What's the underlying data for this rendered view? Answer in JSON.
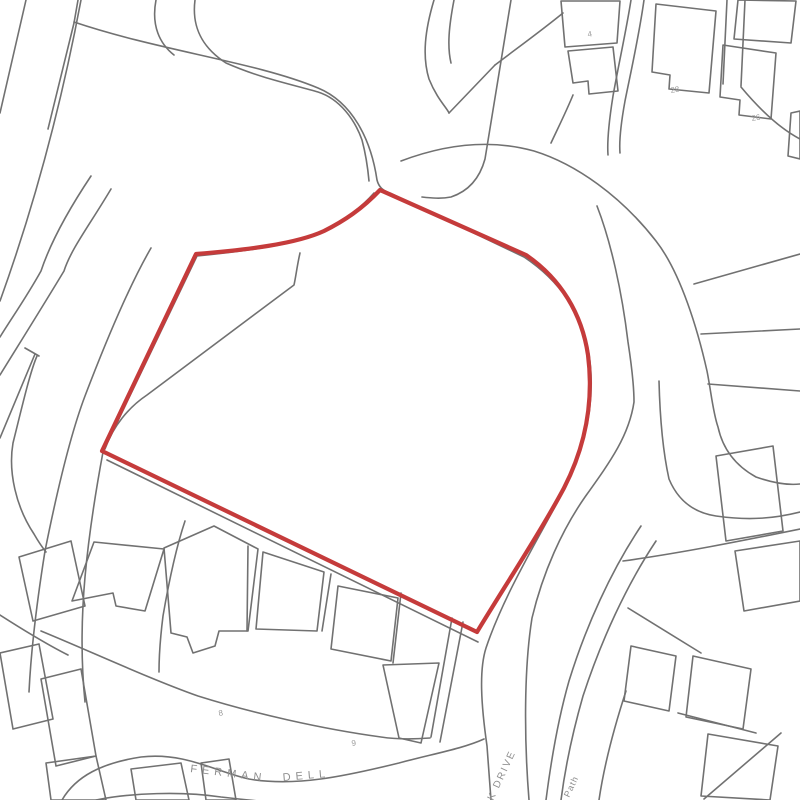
{
  "map": {
    "title": "site-location-plan",
    "background": "#ffffff",
    "line_color": "#717171",
    "line_width": 1.6,
    "red_color": "#c53b3b",
    "red_width": 4.2,
    "label_color": "#8f8f8f",
    "number_color": "#9a9a9a",
    "site_boundary": "M 380,190 C 362,209 344,221 324,231 C 296,244 246,250 196,254 L 102,451 L 477,632 C 503,589 541,531 564,488 C 585,447 594,402 588,355 C 582,314 561,279 526,255 Z",
    "roads_and_parcels": [
      "M 26,0 L 0,113",
      "M 81,0 C 63,96 36,201 0,301",
      "M 78,0 L 74,23 L 48,129",
      "M 156,0 C 151,26 160,44 174,55",
      "M 195,0 C 191,31 206,50 226,63 C 260,78 290,84 318,92 C 340,99 355,120 362,140 C 366,155 368,170 369,181",
      "M 74,22 C 160,51 256,62 318,88 C 352,102 371,139 377,180 C 379,188 384,191 390,193 L 524,257 C 560,281 582,314 589,354 C 596,400 586,446 564,490 C 541,534 504,594 486,648 C 479,670 481,704 487,746 L 491,800",
      "M 374,193 C 360,209 343,221 323,232 C 295,245 246,251 197,256 L 103,452 C 95,495 89,533 85,577 C 81,622 81,662 85,702",
      "M 151,248 C 129,286 106,341 85,396 C 71,433 57,491 45,551 C 37,601 31,651 29,692",
      "M 91,176 C 71,206 51,241 41,271 C 26,298 11,319 0,337",
      "M 111,189 C 89,226 71,249 64,271 C 46,301 21,341 0,375",
      "M 35,354 L 0,438",
      "M 25,348 L 39,356",
      "M 37,356 C 30,372 22,407 13,443 C 8,472 16,507 34,534 C 38,541 42,547 46,552",
      "M 300,253 C 297,266 296,276 294,285 L 147,395 C 129,407 113,426 105,449",
      "M 107,460 L 478,642",
      "M 434,0 C 425,30 422,56 429,79 C 437,99 447,108 449,113",
      "M 454,0 C 449,26 447,46 451,63",
      "M 449,113 L 495,65",
      "M 495,65 C 516,49 541,31 563,13",
      "M 573,95 C 566,112 558,128 551,143",
      "M 511,0 C 502,56 493,111 485,159 C 479,181 466,192 451,197 C 441,199 431,198 422,197",
      "M 401,161 C 446,144 491,139 534,151 C 576,164 621,196 656,241 C 681,273 698,331 707,371 C 711,391 713,413 718,427 C 723,450 736,466 756,477 C 776,484 791,485 800,484",
      "M 597,206 C 611,242 622,292 628,342 C 632,368 634,388 634,402 C 629,436 610,462 585,497 C 562,530 543,572 532,618 C 524,668 524,738 529,800",
      "M 659,381 C 660,421 663,452 669,479 C 679,503 696,513 716,516 C 751,521 776,518 800,512",
      "M 623,561 C 681,553 741,541 800,529",
      "M 641,526 C 611,571 586,626 569,681 C 559,716 551,761 546,800",
      "M 656,541 C 626,586 601,641 583,696 C 573,731 565,769 561,800",
      "M 626,691 C 613,731 604,766 599,800",
      "M 631,0 C 626,32 619,62 613,96 C 609,121 607,141 608,155",
      "M 644,0 C 639,36 631,71 625,101 C 621,123 619,141 620,153",
      "M 694,284 L 800,254",
      "M 701,334 L 800,329",
      "M 708,384 L 800,391",
      "M 727,0 L 723,84",
      "M 745,0 L 741,86",
      "M 741,87 C 761,111 781,129 800,139",
      "M 185,521 C 176,548 169,581 163,616 C 160,640 159,658 159,672",
      "M 248,546 L 247,631",
      "M 331,574 L 322,631",
      "M 401,593 L 393,663",
      "M 452,618 L 431,737",
      "M 463,622 L 440,742",
      "M 41,631 C 92,652 150,679 198,696 C 252,713 322,729 381,737 C 400,740 417,739 430,738",
      "M 62,800 C 76,776 102,763 141,757 C 186,752 216,772 249,779 C 296,787 346,776 399,763 C 432,754 462,749 484,739",
      "M 96,800 C 131,793 181,791 221,797 C 238,799 249,800 258,801",
      "M 0,615 C 25,631 48,645 68,655",
      "M 628,608 L 701,653",
      "M 678,713 L 756,733",
      "M 704,799 L 781,733"
    ],
    "buildings": [
      "M 19,557 L 71,541 L 85,606 L 33,621 Z",
      "M 94,542 L 164,549 L 145,611 L 116,606 L 113,593 L 72,601 Z",
      "M 164,548 L 214,526 L 258,549 L 248,631 L 219,631 L 215,646 L 193,653 L 187,637 L 171,633 Z",
      "M 263,552 L 324,572 L 317,631 L 256,629 Z",
      "M 338,586 L 398,598 L 391,661 L 331,649 Z",
      "M 383,665 L 439,663 L 421,743 L 399,738 Z",
      "M 41,679 L 81,669 L 96,756 L 56,766 Z",
      "M 0,653 L 39,644 L 53,719 L 13,729 Z",
      "M 46,763 L 96,756 L 106,800 L 51,800 Z",
      "M 131,769 L 181,763 L 189,800 L 136,800 Z",
      "M 201,763 L 229,759 L 236,800 L 206,800 Z",
      "M 656,4 L 716,11 L 709,93 L 669,89 L 670,75 L 652,72 Z",
      "M 723,45 L 776,53 L 771,119 L 739,115 L 740,100 L 720,97 Z",
      "M 561,1 L 620,1 L 617,43 L 565,47 Z",
      "M 568,51 L 613,47 L 618,91 L 589,94 L 588,81 L 573,83 Z",
      "M 738,0 L 796,1 L 791,43 L 734,39 Z",
      "M 791,113 L 800,111 L 800,159 L 788,156 Z",
      "M 716,456 L 773,446 L 783,531 L 726,541 Z",
      "M 735,551 L 800,541 L 800,601 L 744,611 Z",
      "M 631,646 L 676,656 L 669,711 L 624,701 Z",
      "M 693,656 L 751,669 L 743,729 L 686,717 Z",
      "M 708,734 L 778,746 L 770,800 L 701,796 Z"
    ],
    "street_labels": [
      {
        "text": "FERMAN",
        "x": 190,
        "y": 772,
        "rotate": 7,
        "size": 11,
        "spacing": 5
      },
      {
        "text": "DELL",
        "x": 283,
        "y": 781,
        "rotate": -5,
        "size": 11,
        "spacing": 5
      },
      {
        "text": "K DRIVE",
        "x": 493,
        "y": 801,
        "rotate": -65,
        "size": 10,
        "spacing": 2
      },
      {
        "text": "Cycle Path",
        "x": 556,
        "y": 826,
        "rotate": -65,
        "size": 9,
        "spacing": 1
      }
    ],
    "house_numbers": [
      {
        "text": "28",
        "x": 671,
        "y": 93,
        "rotate": -10,
        "size": 8
      },
      {
        "text": "26",
        "x": 752,
        "y": 121,
        "rotate": -10,
        "size": 8
      },
      {
        "text": "4",
        "x": 588,
        "y": 37,
        "rotate": -10,
        "size": 8
      },
      {
        "text": "8",
        "x": 219,
        "y": 716,
        "rotate": -10,
        "size": 8
      },
      {
        "text": "9",
        "x": 352,
        "y": 746,
        "rotate": -10,
        "size": 8
      }
    ]
  }
}
